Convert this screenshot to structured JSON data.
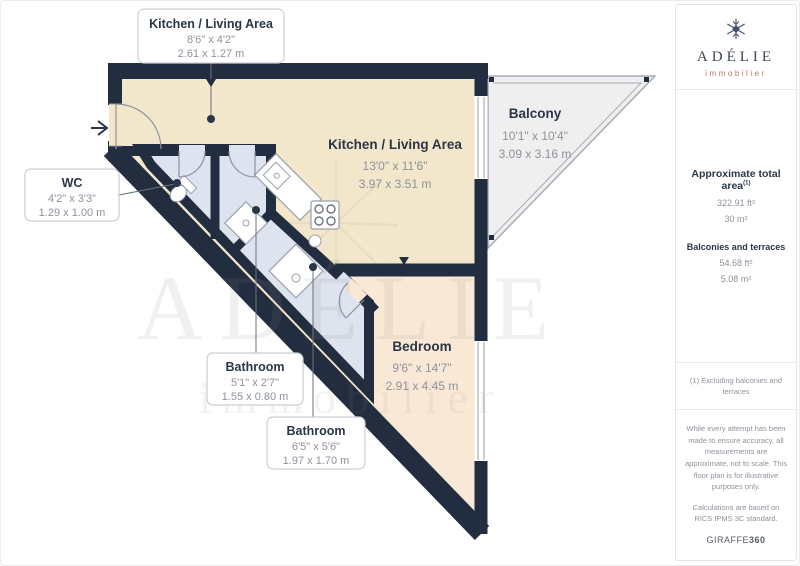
{
  "branding": {
    "logo_name": "ADÉLIE",
    "logo_subtitle": "immobilier",
    "accent_color": "#c4756b",
    "navy_color": "#222d40"
  },
  "sidebar": {
    "total_area": {
      "label": "Approximate total area",
      "footnote_marker": "(1)",
      "imperial": "322.91 ft²",
      "metric": "30 m²"
    },
    "balconies": {
      "label": "Balconies and terraces",
      "imperial": "54.68 ft²",
      "metric": "5.08 m²"
    },
    "footnote": "(1) Excluding balconies and terraces",
    "disclaimer1": "While every attempt has been made to ensure accuracy, all measurements are approximate, not to scale. This floor plan is for illustrative purposes only.",
    "disclaimer2": "Calculations are based on RICS IPMS 3C standard.",
    "provider": {
      "name": "GIRAFFE",
      "suffix": "360"
    }
  },
  "floorplan": {
    "rooms": [
      {
        "name": "Kitchen / Living Area",
        "imperial": "13'0\" x 11'6\"",
        "metric": "3.97 x 3.51 m"
      },
      {
        "name": "Balcony",
        "imperial": "10'1\" x 10'4\"",
        "metric": "3.09 x 3.16 m"
      },
      {
        "name": "Bedroom",
        "imperial": "9'6\" x 14'7\"",
        "metric": "2.91 x 4.45 m"
      }
    ],
    "callouts": [
      {
        "name": "Kitchen / Living Area",
        "imperial": "8'6\" x 4'2\"",
        "metric": "2.61 x 1.27 m"
      },
      {
        "name": "WC",
        "imperial": "4'2\" x 3'3\"",
        "metric": "1.29 x 1.00 m"
      },
      {
        "name": "Bathroom",
        "imperial": "5'1\" x 2'7\"",
        "metric": "1.55 x 0.80 m"
      },
      {
        "name": "Bathroom",
        "imperial": "6'5\" x 5'6\"",
        "metric": "1.97 x 1.70 m"
      }
    ],
    "watermark": {
      "line1": "ADÉLIE",
      "line2": "immobilier"
    },
    "colors": {
      "wall": "#222d40",
      "living_floor": "#f2e6cb",
      "bedroom_floor": "#fae8d6",
      "bathroom_floor": "#dde3ef",
      "balcony_floor": "#efefef"
    }
  }
}
